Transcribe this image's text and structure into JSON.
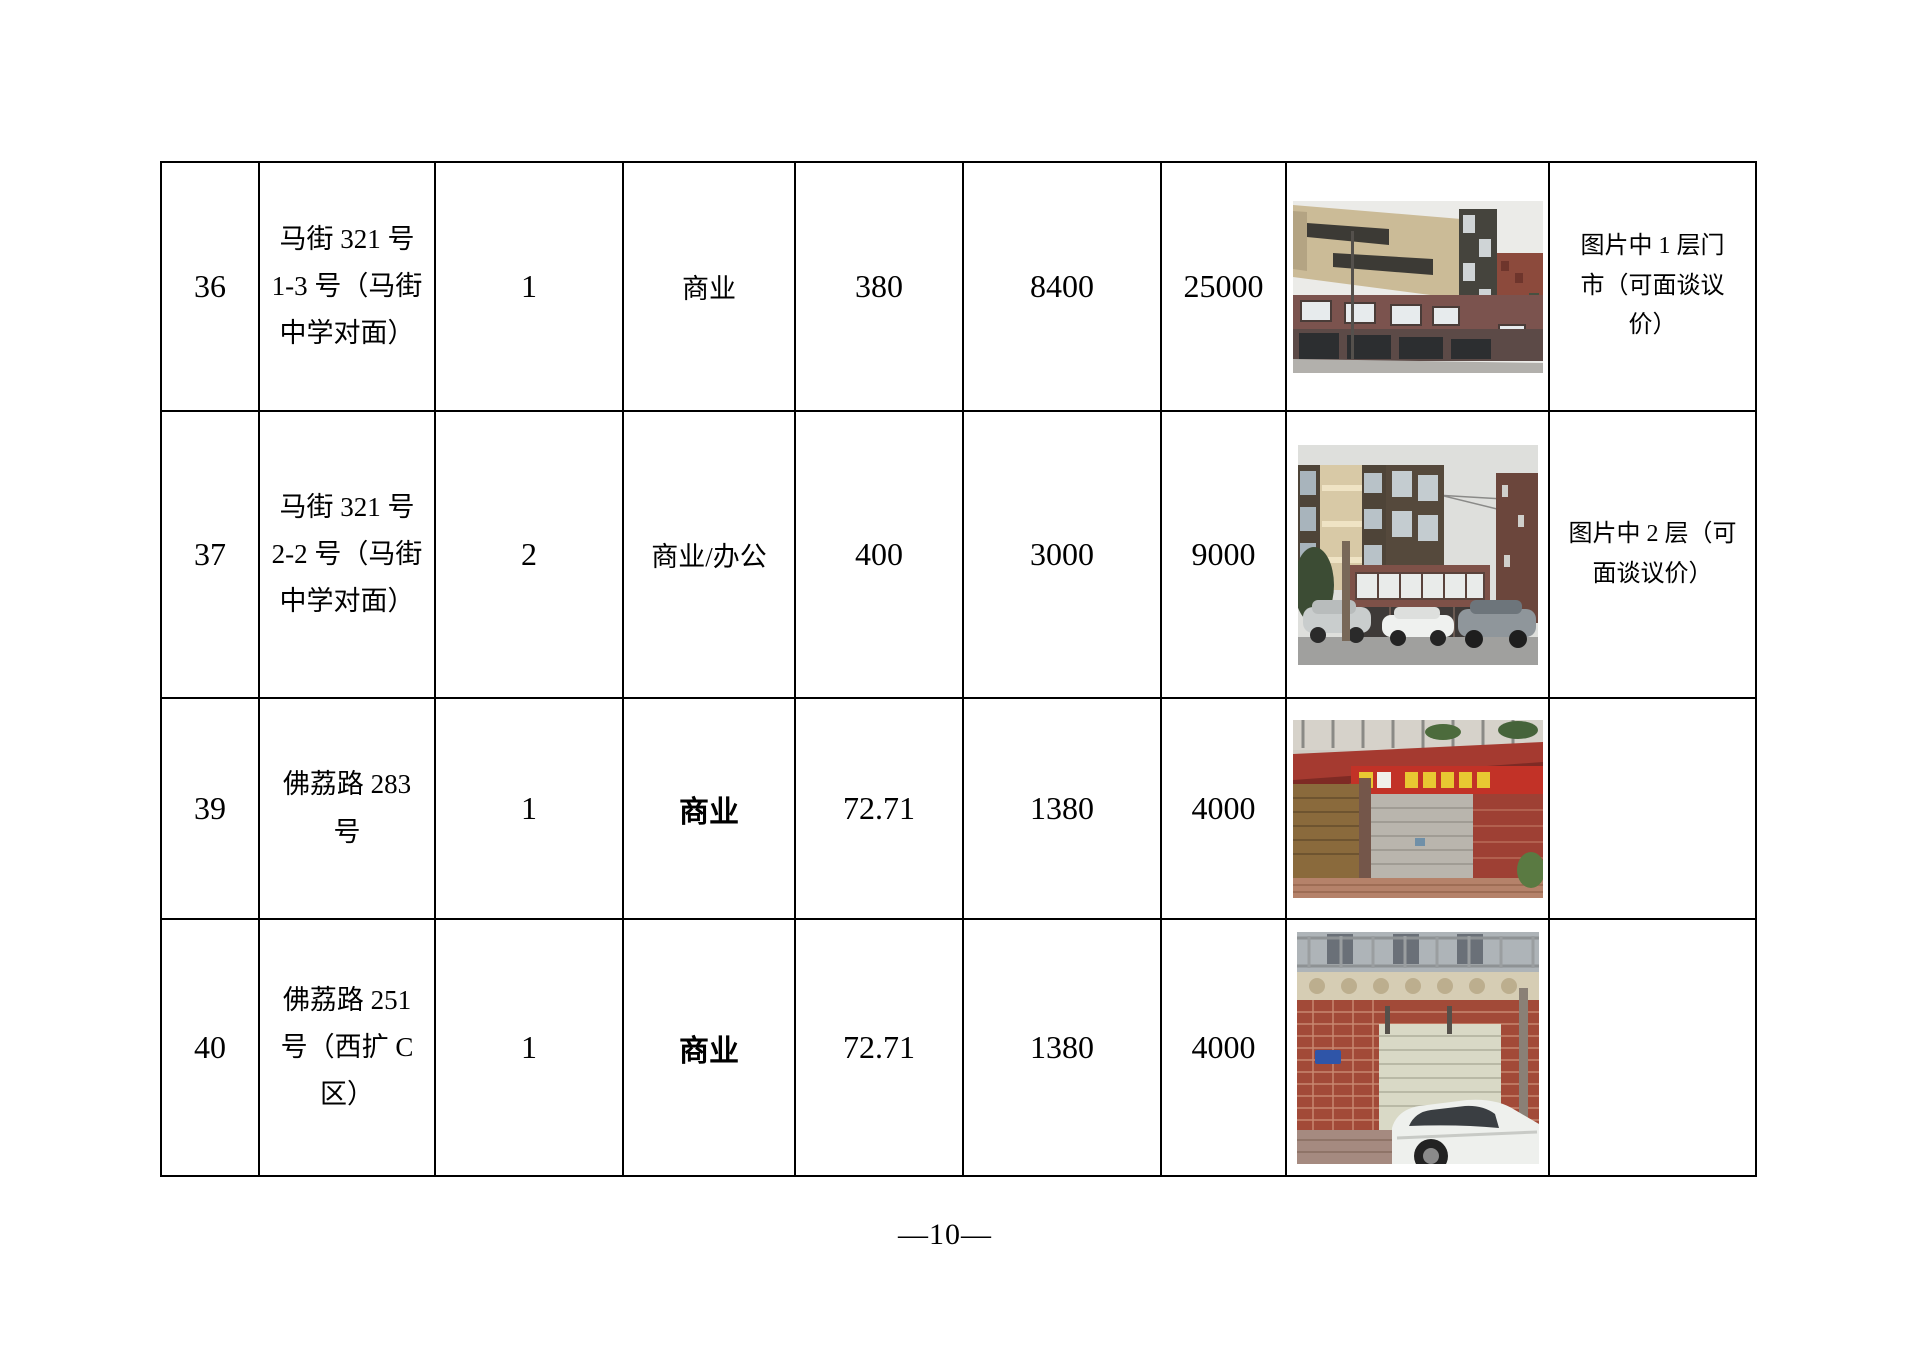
{
  "page": {
    "page_number": "—10—"
  },
  "table": {
    "rows": [
      {
        "no": "36",
        "address": "马街 321 号\n1-3 号（马街\n中学对面）",
        "floor": "1",
        "usage": "商业",
        "area": "380",
        "rent": "8400",
        "price": "25000",
        "photo": "commercial-building-facade-photo",
        "remark": "图片中 1 层门\n市（可面谈议\n价）"
      },
      {
        "no": "37",
        "address": "马街 321 号\n2-2 号（马街\n中学对面）",
        "floor": "2",
        "usage": "商业/办公",
        "area": "400",
        "rent": "3000",
        "price": "9000",
        "photo": "residential-building-street-cars-photo",
        "remark": "图片中 2 层（可\n面谈议价）"
      },
      {
        "no": "39",
        "address": "佛荔路 283\n号",
        "floor": "1",
        "usage": "商业",
        "area": "72.71",
        "rent": "1380",
        "price": "4000",
        "photo": "shop-red-awning-shutter-photo",
        "remark": ""
      },
      {
        "no": "40",
        "address": "佛荔路 251\n号（西扩 C\n区）",
        "floor": "1",
        "usage": "商业",
        "area": "72.71",
        "rent": "1380",
        "price": "4000",
        "photo": "brick-garage-white-car-photo",
        "remark": ""
      }
    ]
  }
}
